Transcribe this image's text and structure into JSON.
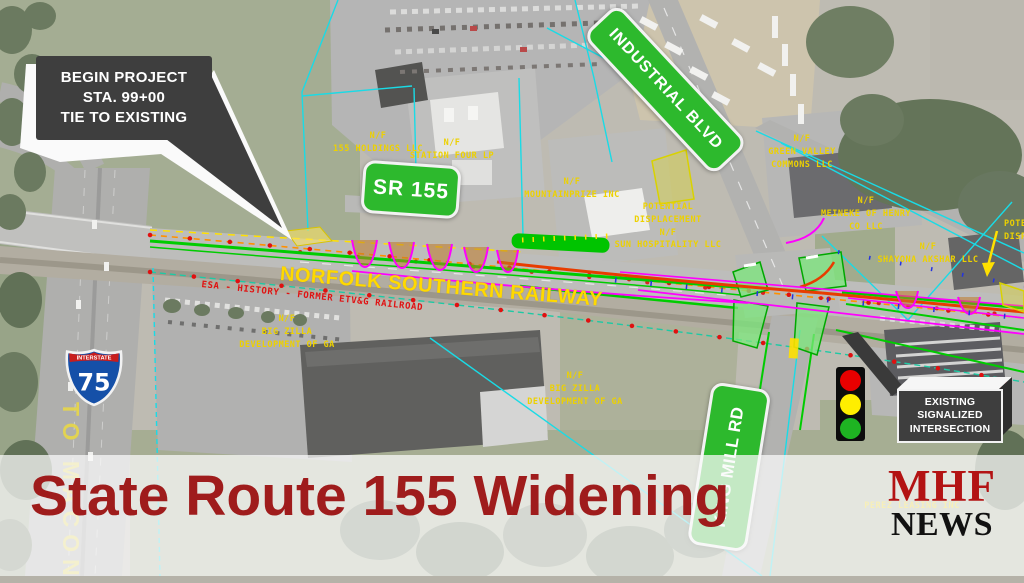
{
  "banner": {
    "title": "State Route 155 Widening"
  },
  "logo": {
    "line1": "MHF",
    "line2": "NEWS"
  },
  "callouts": {
    "begin_project": "BEGIN PROJECT\nSTA. 99+00\nTIE TO EXISTING",
    "existing_signal": "EXISTING\nSIGNALIZED\nINTERSECTION"
  },
  "signs": {
    "sr155": "SR 155",
    "industrial_blvd": "INDUSTRIAL BLVD",
    "king_mill_rd": "KING MILL RD"
  },
  "interstate": {
    "label": "INTERSTATE",
    "number": "75"
  },
  "map_labels": {
    "railway": "NORFOLK SOUTHERN RAILWAY",
    "to_macon": "TO MACON",
    "esa_history": "ESA - HISTORY - FORMER ETV&G RAILROAD",
    "esa_right": "ESA",
    "parcels": [
      {
        "text": "N/F\n155 HOLDINGS LLC"
      },
      {
        "text": "N/F\nSTATION FOUR LP"
      },
      {
        "text": "N/F\nMOUNTAINPRIZE INC"
      },
      {
        "text": "POTENTIAL\nDISPLACEMENT\nN/F\nSUN HOSPITALITY LLC"
      },
      {
        "text": "N/F\nGREEN VALLEY\nCOMMONS LLC"
      },
      {
        "text": "N/F\nMEINEKE OF HENRY\nCO LLC"
      },
      {
        "text": "N/F\nSHAYONA AKSHAR LLC"
      },
      {
        "text": "N/F\nBIG ZILLA\nDEVELOPMENT OF GA"
      },
      {
        "text": "N/F\nBIG ZILLA\nDEVELOPMENT OF GA"
      },
      {
        "text": "PEREZ LEASING INC"
      },
      {
        "text": "POTENTIAL\nDISPLACEMENT"
      }
    ]
  },
  "colors": {
    "headline_red": "#9f1c1c",
    "sign_green": "#2db92d",
    "callout_gray": "#3e3e3e",
    "cad_yellow": "#edd100",
    "cad_red": "#e01212",
    "railway_yellow": "#ffd900",
    "interstate_blue": "#1550a8",
    "interstate_red": "#c81d1d",
    "signal_red": "#e80000",
    "signal_yellow": "#ffee00",
    "signal_green": "#1eb422"
  }
}
